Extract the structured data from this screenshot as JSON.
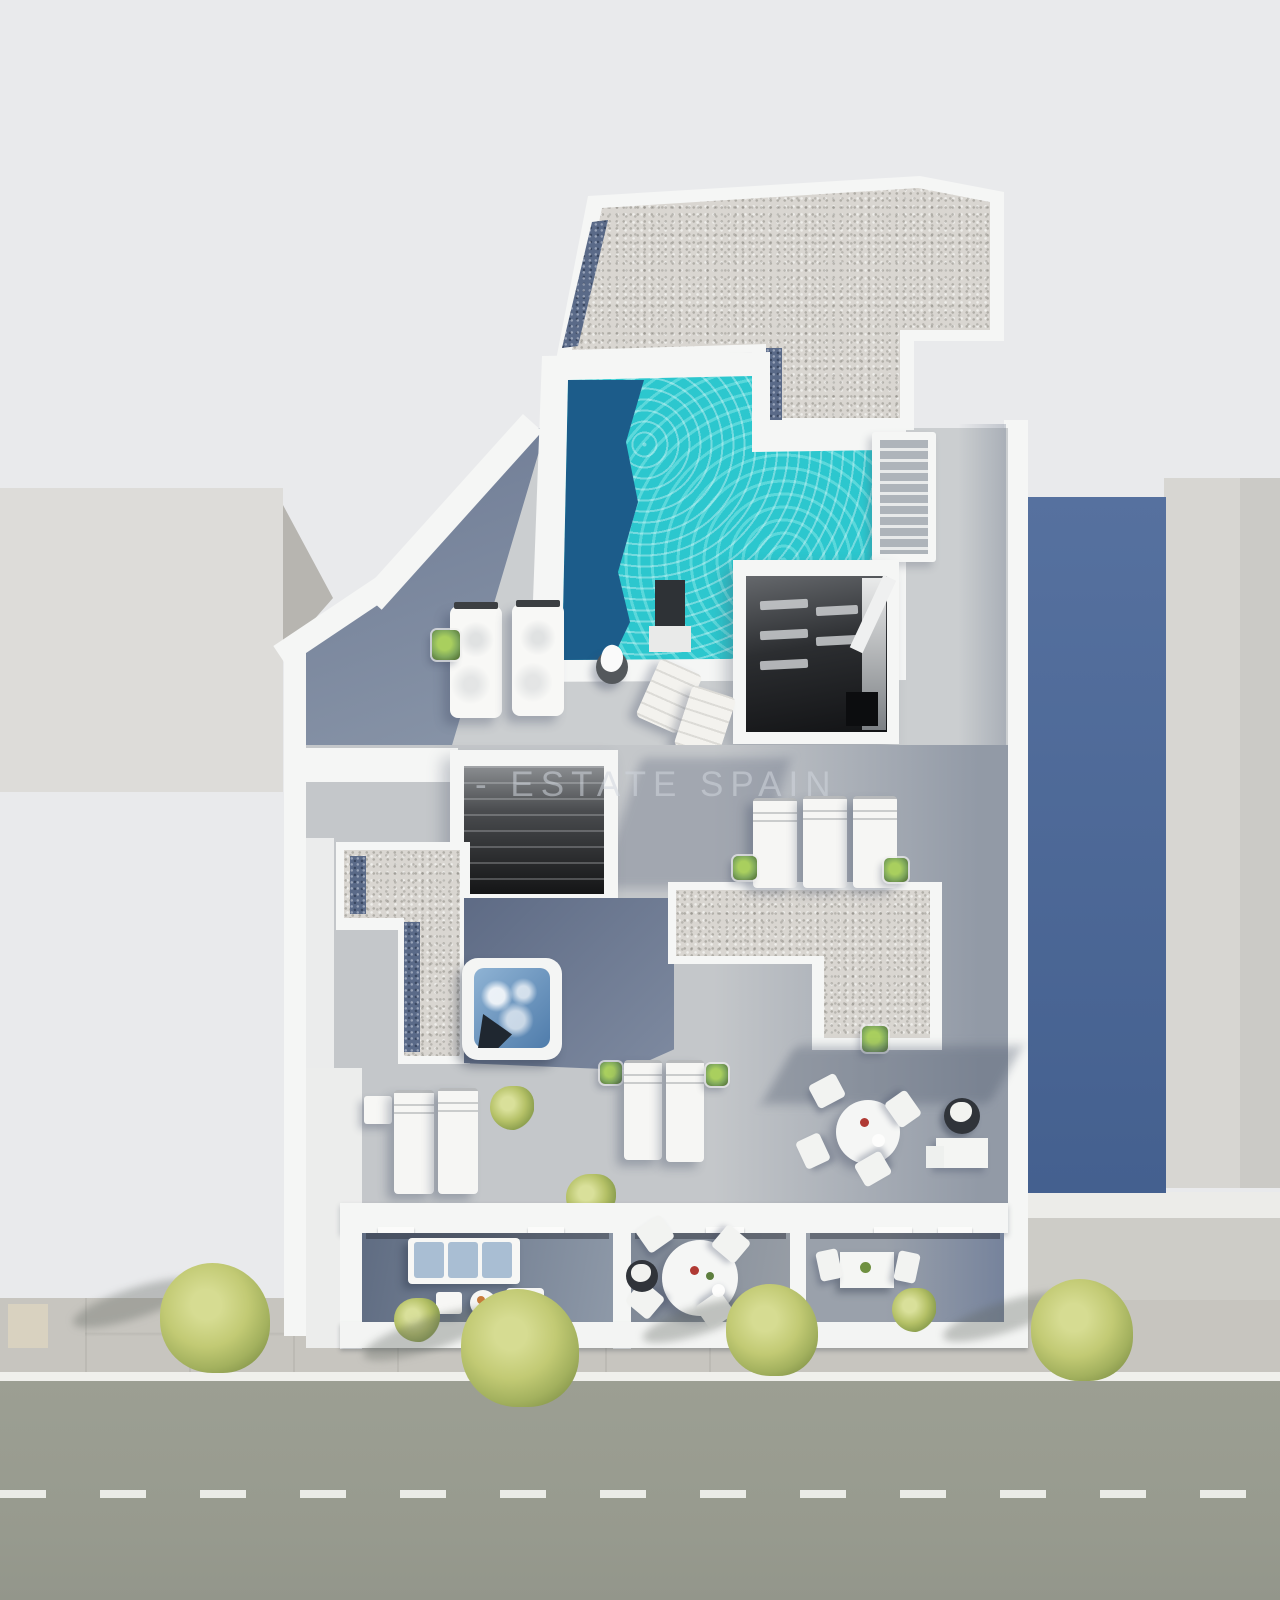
{
  "watermark": {
    "text": "- ESTATE SPAIN"
  },
  "colors": {
    "bg": "#e9eaec",
    "street": "#9c9f93",
    "sidewalk": "#c7c5bf",
    "curb": "#f0f0ec",
    "tactile": "#d9d2c0",
    "bldg_left": "#dddcd9",
    "bldg_left_side": "#b7b5b0",
    "bldg_right": "#d7d6d2",
    "bldg_right_edge": "#cbcac6",
    "shadow_wall_a": "#56719f",
    "shadow_wall_b": "#44608f",
    "wall": "#f5f6f5",
    "deck_dark_a": "#6d7a94",
    "deck_dark_b": "#94a0b0",
    "gravel": "#d9d6d1",
    "gravel_border": "#5a6a88",
    "pool": "#2cc7ce",
    "pool_deep": "#1c5c8a",
    "jacuzzi": "#4f7cab",
    "opening_a": "#65686c",
    "opening_b": "#121315",
    "step_dark": "#aeb4ba",
    "tree_a": "#d6dc92",
    "tree_b": "#c2ca74",
    "tree_c": "#a3b15e",
    "plant": "#7fa85c",
    "cushion": "#a9bed3",
    "planter": "#30343a",
    "watermark": "rgba(208,214,221,0.55)"
  }
}
